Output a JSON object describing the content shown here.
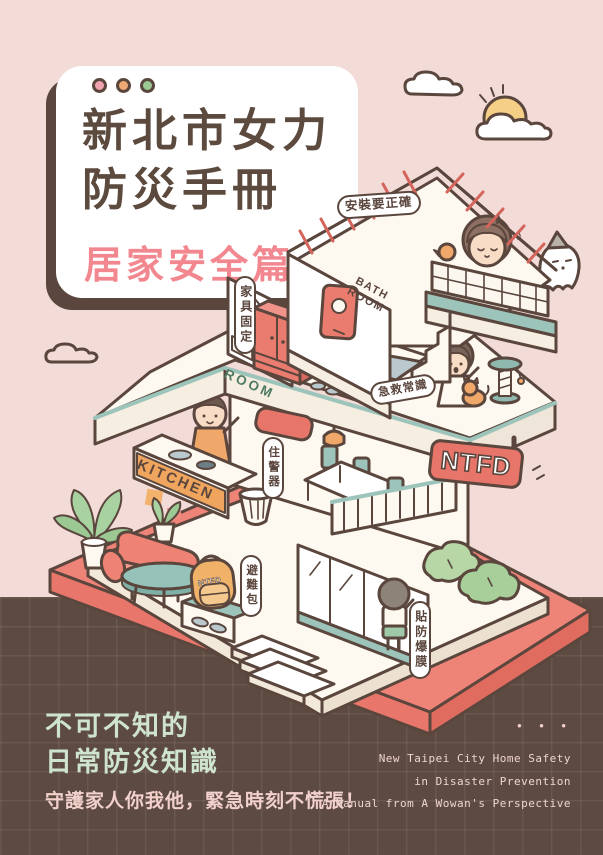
{
  "card": {
    "title_line1": "新北市女力",
    "title_line2": "防災手冊",
    "subtitle": "居家安全篇"
  },
  "labels": {
    "install": "安裝要正確",
    "furniture": "家具固定",
    "first_aid": "急救常識",
    "alarm": "住警器",
    "go_bag": "避難包",
    "film": "貼防爆膜"
  },
  "signs": {
    "bathroom": "BATH\nROOM",
    "room": "ROOM",
    "kitchen": "KITCHEN",
    "ntfd": "NTFD",
    "backpack": "NTFD"
  },
  "decorations": {
    "music_note": "♪"
  },
  "footer": {
    "headline_line1": "不可不知的",
    "headline_line2": "日常防災知識",
    "tagline": "守護家人你我他，緊急時刻不慌張！",
    "dots": "• • •",
    "en_line1": "New Taipei City Home Safety",
    "en_line2": "in Disaster Prevention",
    "en_line3": "A Manual from A Wowan's Perspective"
  },
  "colors": {
    "background": "#f3dbd8",
    "footer_brown": "#5d4b41",
    "outline_brown": "#5a463d",
    "title_brown": "#5d4a3e",
    "title_pink": "#f2878f",
    "roof_red": "#e97a6e",
    "sign_red": "#e8756a",
    "teal": "#9dc4bb",
    "orange": "#efa55e",
    "mint_text": "#cfe4cf",
    "pink_text": "#f2d0cb",
    "dot_pink": "#f0a3ad",
    "dot_orange": "#f0a875",
    "dot_green": "#9cc993"
  }
}
